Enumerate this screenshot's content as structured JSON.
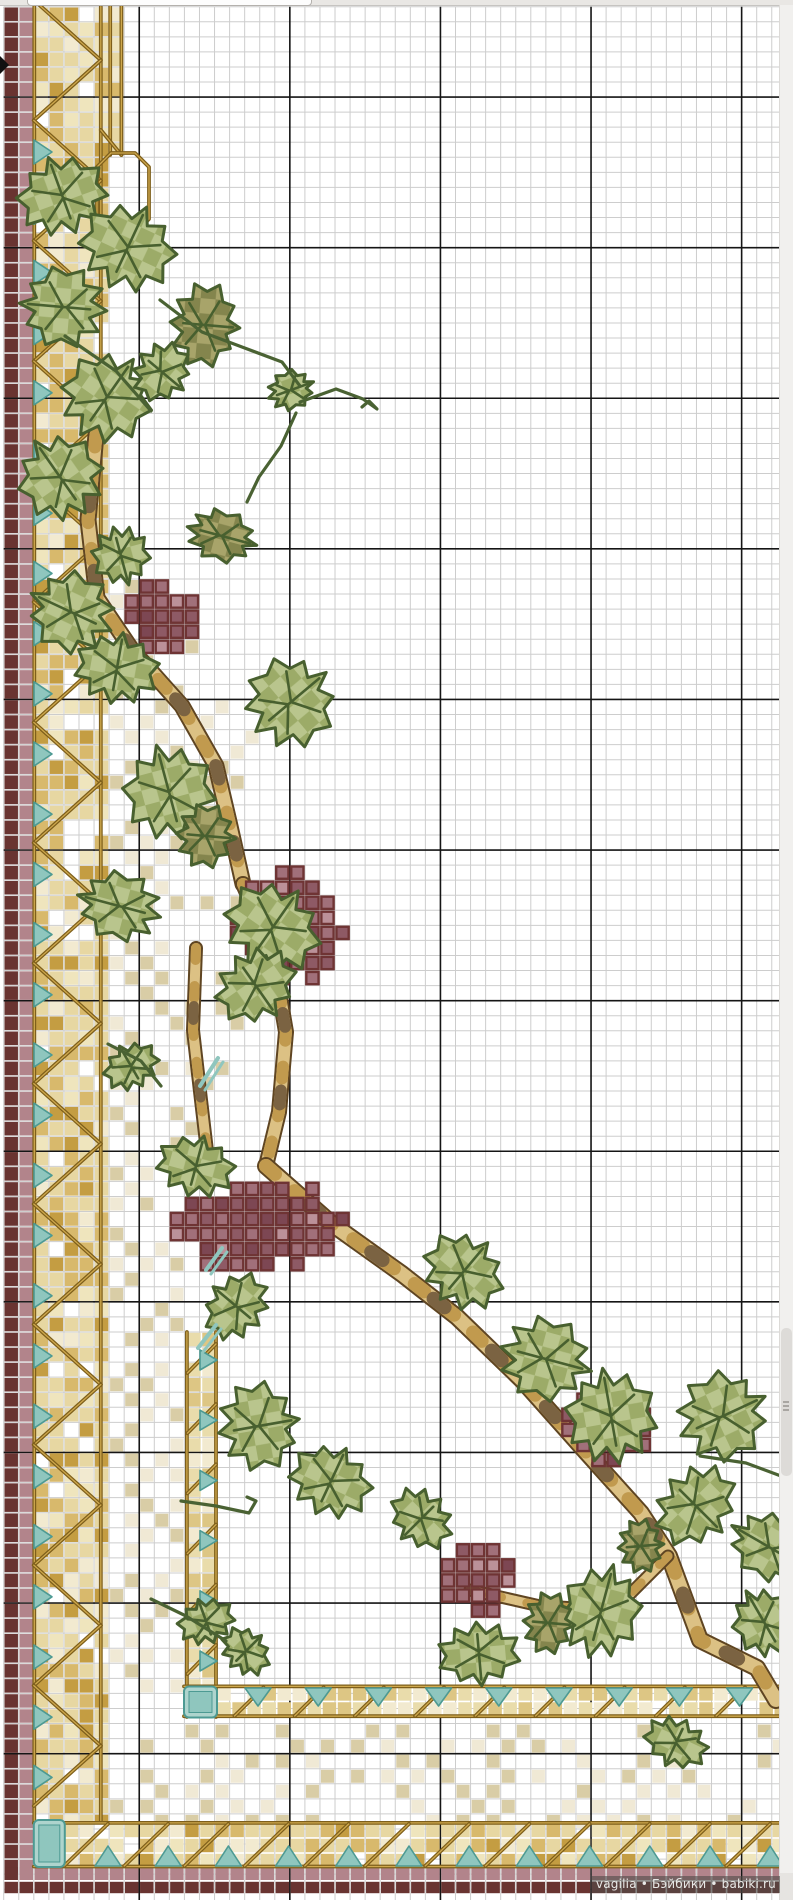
{
  "watermark": {
    "text": "vagilia • Бэйбики • babiki.ru"
  },
  "grid": {
    "cell": 15.06,
    "x0": 3.7,
    "y0": 6.7,
    "w": 779,
    "h": 1900,
    "minor_color": "#cdcdcd",
    "major_color": "#151515",
    "major_col_offset": 9,
    "major_row_offset": 6,
    "major_every": 10,
    "cols": 51,
    "rows": 126
  },
  "palette": {
    "maroon": "#693431",
    "mauve": "#b2848b",
    "band": [
      "#f2ead0",
      "#e7d7a2",
      "#d8b96c",
      "#c49d42",
      "#efe5bd"
    ],
    "band_inner": [
      "#f2ead0",
      "#e9dcab",
      "#ddc684"
    ],
    "cable": "#7e5f1b",
    "cable_hi": "#cfa94e",
    "teal": "#8fc6be",
    "teal_dark": "#4d9a93",
    "teal_light": "#aed4cd",
    "leaf_light": [
      "#b9c58d",
      "#9cab68"
    ],
    "leaf_olive": [
      "#a8a46a",
      "#84854d"
    ],
    "leaf_line": "#48602f",
    "grape": [
      "#bb9199",
      "#a1707a",
      "#8e5a65",
      "#7d4753"
    ],
    "grape_line": "#6f3434",
    "trunk_dark": "#5f4522",
    "trunk_fill": "#dcc184",
    "trunk_mid": "#c19a4e",
    "trunk_brown": "#7b6342",
    "tendril": "#4a6233",
    "speckle": [
      "#d9cda6",
      "#f0e9d5"
    ]
  },
  "borders": {
    "maroon_col_x": 3.7,
    "mauve_col_x": 18.76,
    "col_w": 15.06,
    "cols_y_end": 1866,
    "bottom_mauve_y": 1866.3,
    "bottom_mauve_h": 14.5,
    "bottom_maroon_y": 1881,
    "bottom_maroon_h": 13,
    "lattice_left": {
      "x": 33.8,
      "cols": 5,
      "y0": 6.7,
      "y1": 1822
    },
    "lattice_top_ext": {
      "x": 109.1,
      "cols": 1,
      "y0": 6.7,
      "y1": 155
    },
    "lattice_bottom": {
      "y": 1822.9,
      "rows": 3,
      "x0": 33.8,
      "x1": 779
    },
    "inner_v": {
      "x": 186.4,
      "cols": 2,
      "y0": 1332,
      "y1": 1717
    },
    "inner_h": {
      "y": 1686.4,
      "rows": 2,
      "x0": 216.5,
      "x1": 779
    },
    "corner_outer": {
      "x": 33.8,
      "y": 1820,
      "w": 31,
      "h": 47
    },
    "corner_inner": {
      "x": 184,
      "y": 1686.5,
      "w": 33,
      "h": 31
    },
    "octagon": [
      [
        111,
        153
      ],
      [
        135,
        153
      ],
      [
        149,
        167
      ],
      [
        149,
        219
      ],
      [
        135,
        233
      ],
      [
        111,
        233
      ],
      [
        97,
        219
      ],
      [
        97,
        167
      ]
    ],
    "cable_period": 60.2
  },
  "triangles": {
    "left": {
      "x": 34,
      "w": 18,
      "h": 24,
      "y0": 140,
      "y1": 1795,
      "step": 60.2
    },
    "bottom": {
      "y": 1866,
      "w": 26,
      "h": 20,
      "x0": 95,
      "x1": 765,
      "step": 60.2
    },
    "inner_v": {
      "x": 200,
      "w": 17,
      "h": 20,
      "y0": 1350,
      "y1": 1675,
      "step": 60.2
    },
    "inner_h": {
      "y": 1688,
      "w": 26,
      "h": 18,
      "x0": 245,
      "x1": 770,
      "step": 60.2
    }
  },
  "speckle_regions": [
    {
      "x": 108,
      "y": 575,
      "w": 145,
      "h": 760,
      "density": 55,
      "fade": true
    },
    {
      "x": 95,
      "y": 1335,
      "w": 91,
      "h": 355,
      "density": 62,
      "fade": false
    },
    {
      "x": 108,
      "y": 1718,
      "w": 671,
      "h": 102,
      "density": 55,
      "fade": false
    }
  ],
  "vine": {
    "trunks": [
      {
        "w": 13,
        "pts": [
          [
            96,
            435
          ],
          [
            88,
            520
          ],
          [
            97,
            598
          ],
          [
            132,
            650
          ],
          [
            182,
            706
          ],
          [
            216,
            766
          ],
          [
            230,
            826
          ],
          [
            243,
            884
          ]
        ]
      },
      {
        "w": 10,
        "pts": [
          [
            196,
            948
          ],
          [
            193,
            1030
          ],
          [
            201,
            1100
          ],
          [
            209,
            1168
          ]
        ]
      },
      {
        "w": 12,
        "pts": [
          [
            243,
            884
          ],
          [
            272,
            950
          ],
          [
            286,
            1032
          ],
          [
            279,
            1112
          ],
          [
            266,
            1166
          ]
        ]
      },
      {
        "w": 14,
        "pts": [
          [
            266,
            1166
          ],
          [
            332,
            1224
          ],
          [
            402,
            1274
          ],
          [
            457,
            1317
          ],
          [
            522,
            1380
          ],
          [
            587,
            1453
          ],
          [
            641,
            1513
          ],
          [
            669,
            1556
          ],
          [
            700,
            1640
          ],
          [
            757,
            1668
          ],
          [
            776,
            1700
          ]
        ]
      },
      {
        "w": 9,
        "pts": [
          [
            668,
            1556
          ],
          [
            614,
            1610
          ],
          [
            540,
            1606
          ],
          [
            470,
            1590
          ]
        ]
      }
    ],
    "tendrils": [
      [
        [
          160,
          300
        ],
        [
          202,
          332
        ],
        [
          242,
          347
        ],
        [
          282,
          362
        ],
        [
          300,
          386
        ]
      ],
      [
        [
          300,
          402
        ],
        [
          336,
          389
        ],
        [
          363,
          399
        ],
        [
          377,
          409
        ],
        [
          369,
          401
        ],
        [
          362,
          407
        ]
      ],
      [
        [
          296,
          413
        ],
        [
          281,
          446
        ],
        [
          259,
          477
        ],
        [
          247,
          502
        ]
      ],
      [
        [
          65,
          336
        ],
        [
          116,
          371
        ],
        [
          151,
          411
        ]
      ],
      [
        [
          108,
          1044
        ],
        [
          141,
          1061
        ],
        [
          161,
          1086
        ]
      ],
      [
        [
          181,
          1501
        ],
        [
          216,
          1506
        ],
        [
          249,
          1513
        ],
        [
          256,
          1501
        ],
        [
          247,
          1497
        ]
      ],
      [
        [
          700,
          1456
        ],
        [
          746,
          1463
        ],
        [
          789,
          1479
        ]
      ],
      [
        [
          151,
          1599
        ],
        [
          186,
          1616
        ],
        [
          226,
          1641
        ]
      ]
    ],
    "teal_accents": [
      [
        218,
        1058,
        200,
        1086
      ],
      [
        222,
        1248,
        206,
        1270
      ],
      [
        216,
        1325,
        198,
        1348
      ]
    ],
    "leaves": [
      [
        62,
        195,
        88,
        80,
        -20,
        "L"
      ],
      [
        128,
        247,
        95,
        88,
        25,
        "L"
      ],
      [
        205,
        325,
        82,
        70,
        95,
        "O"
      ],
      [
        63,
        307,
        78,
        88,
        -85,
        "L"
      ],
      [
        107,
        397,
        88,
        92,
        35,
        "L"
      ],
      [
        162,
        372,
        60,
        56,
        130,
        "L"
      ],
      [
        291,
        390,
        38,
        48,
        70,
        "L"
      ],
      [
        60,
        477,
        82,
        88,
        -35,
        "L"
      ],
      [
        222,
        536,
        50,
        72,
        105,
        "O"
      ],
      [
        121,
        556,
        56,
        60,
        165,
        "L"
      ],
      [
        71,
        612,
        78,
        88,
        -65,
        "L"
      ],
      [
        117,
        668,
        82,
        72,
        10,
        "L"
      ],
      [
        291,
        702,
        88,
        92,
        50,
        "L"
      ],
      [
        169,
        792,
        88,
        97,
        -15,
        "L"
      ],
      [
        206,
        836,
        62,
        60,
        95,
        "O"
      ],
      [
        119,
        906,
        66,
        86,
        -75,
        "L"
      ],
      [
        273,
        927,
        97,
        88,
        35,
        "L"
      ],
      [
        256,
        986,
        82,
        72,
        145,
        "L"
      ],
      [
        131,
        1066,
        56,
        46,
        -30,
        "L"
      ],
      [
        196,
        1166,
        77,
        62,
        15,
        "L"
      ],
      [
        464,
        1271,
        82,
        74,
        40,
        "L"
      ],
      [
        546,
        1359,
        80,
        94,
        105,
        "L"
      ],
      [
        236,
        1306,
        70,
        60,
        -50,
        "L"
      ],
      [
        259,
        1426,
        86,
        82,
        80,
        "L"
      ],
      [
        331,
        1481,
        82,
        72,
        25,
        "L"
      ],
      [
        206,
        1621,
        56,
        46,
        -20,
        "L"
      ],
      [
        246,
        1651,
        52,
        44,
        45,
        "L"
      ],
      [
        611,
        1416,
        88,
        97,
        -10,
        "L"
      ],
      [
        723,
        1416,
        86,
        93,
        65,
        "L"
      ],
      [
        696,
        1506,
        86,
        74,
        135,
        "L"
      ],
      [
        769,
        1547,
        62,
        86,
        -60,
        "L"
      ],
      [
        601,
        1611,
        77,
        96,
        15,
        "L"
      ],
      [
        479,
        1654,
        80,
        64,
        175,
        "L"
      ],
      [
        549,
        1623,
        60,
        52,
        95,
        "O"
      ],
      [
        676,
        1743,
        64,
        50,
        205,
        "L"
      ],
      [
        421,
        1519,
        66,
        56,
        -135,
        "L"
      ],
      [
        764,
        1622,
        60,
        72,
        -30,
        "L"
      ],
      [
        641,
        1546,
        52,
        46,
        85,
        "O"
      ]
    ],
    "grapes": [
      {
        "x": 130,
        "y": 572,
        "w": 73,
        "h": 73
      },
      {
        "x": 228,
        "y": 872,
        "w": 120,
        "h": 118
      },
      {
        "x": 163,
        "y": 1178,
        "w": 182,
        "h": 84
      },
      {
        "x": 556,
        "y": 1398,
        "w": 96,
        "h": 82
      },
      {
        "x": 438,
        "y": 1550,
        "w": 72,
        "h": 80
      }
    ]
  }
}
